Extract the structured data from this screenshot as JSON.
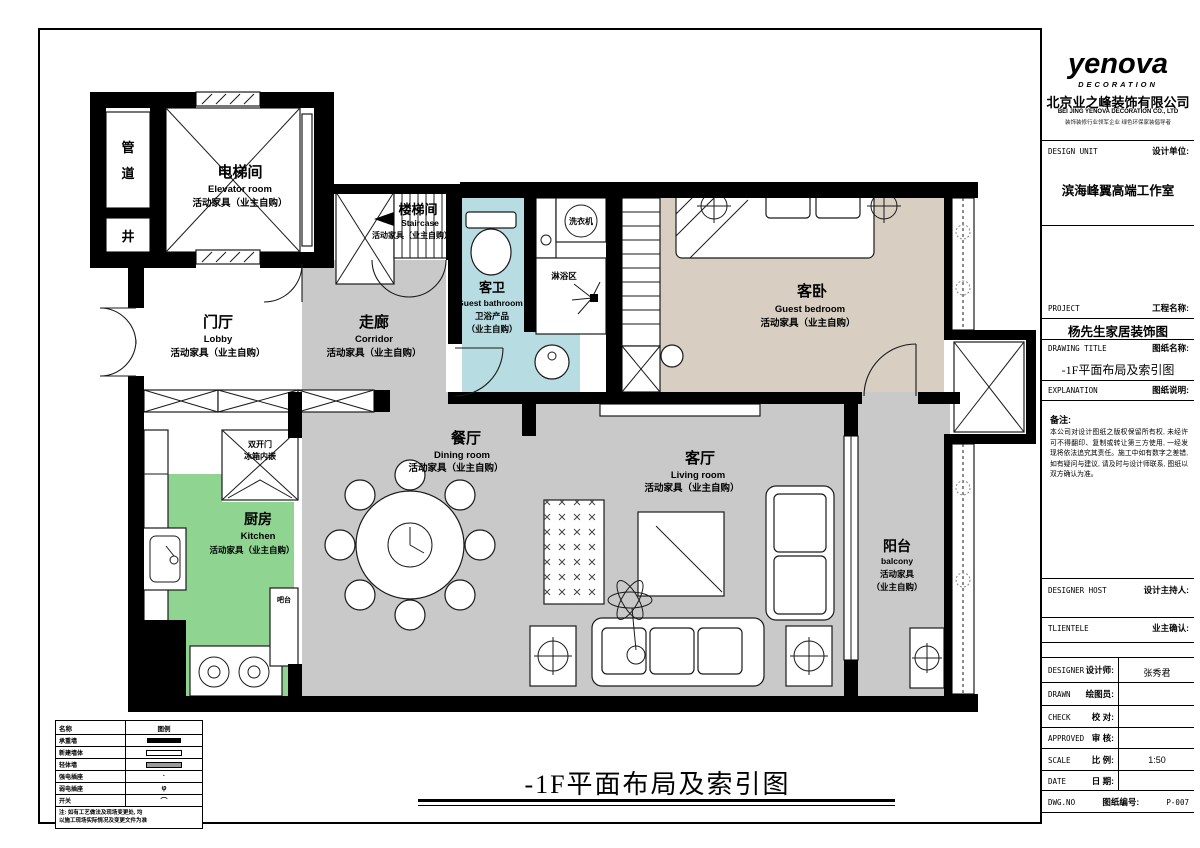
{
  "sheet": {
    "footer_title": "-1F平面布局及索引图"
  },
  "title_block": {
    "logo_text": "yenova",
    "logo_sub": "DECORATION",
    "company_cn": "北京业之峰装饰有限公司",
    "company_en": "BEI JING YENOVA DECORATION CO., LTD",
    "company_tagline": "装饰装修行业领军企业 绿色环保家装倡导者",
    "design_unit_en": "DESIGN UNIT",
    "design_unit_cn": "设计单位:",
    "design_unit_value": "滨海峰翼高端工作室",
    "project_en": "PROJECT",
    "project_cn": "工程名称:",
    "project_value": "杨先生家居装饰图",
    "drawing_title_en": "DRAWING TITLE",
    "drawing_title_cn": "图纸名称:",
    "drawing_title_value": "-1F平面布局及索引图",
    "explanation_en": "EXPLANATION",
    "explanation_cn": "图纸说明:",
    "note_label": "备注:",
    "note_text": "本公司对设计图纸之版权保留所有权, 未经许可不得翻印、复制或转让第三方使用, 一经发现将依法追究其责任。施工中如有数字之差错, 如有疑问与建议, 请及时与设计师联系, 图纸以双方确认为准。",
    "designer_host_en": "DESIGNER HOST",
    "designer_host_cn": "设计主持人:",
    "clientele_en": "TLIENTELE",
    "clientele_cn": "业主确认:",
    "designer_en": "DESIGNER",
    "designer_cn": "设计师:",
    "designer_value": "张秀君",
    "drawn_en": "DRAWN",
    "drawn_cn": "绘图员:",
    "check_en": "CHECK",
    "check_cn": "校 对:",
    "approved_en": "APPROVED",
    "approved_cn": "审 核:",
    "scale_en": "SCALE",
    "scale_cn": "比 例:",
    "scale_value": "1:50",
    "date_en": "DATE",
    "date_cn": "日 期:",
    "dwg_en": "DWG.NO",
    "dwg_cn": "图纸编号:",
    "dwg_value": "P-007"
  },
  "plan": {
    "shaft": {
      "c1": "管",
      "c2": "道",
      "c3": "井"
    },
    "elevator": {
      "cn": "电梯间",
      "en": "Elevator room",
      "note": "活动家具（业主自购）"
    },
    "staircase": {
      "cn": "楼梯间",
      "en": "Staircase",
      "note": "活动家具（业主自购）"
    },
    "lobby": {
      "cn": "门厅",
      "en": "Lobby",
      "note": "活动家具（业主自购）"
    },
    "corridor": {
      "cn": "走廊",
      "en": "Corridor",
      "note": "活动家具（业主自购）"
    },
    "guest_bathroom": {
      "cn": "客卫",
      "en": "Guest bathroom",
      "note1": "卫浴产品",
      "note2": "（业主自购）"
    },
    "washer": "洗衣机",
    "shower": "淋浴区",
    "guest_bedroom": {
      "cn": "客卧",
      "en": "Guest bedroom",
      "note": "活动家具（业主自购）"
    },
    "dining": {
      "cn": "餐厅",
      "en": "Dining room",
      "note": "活动家具（业主自购）"
    },
    "living": {
      "cn": "客厅",
      "en": "Living room",
      "note": "活动家具（业主自购）"
    },
    "kitchen": {
      "cn": "厨房",
      "en": "Kitchen",
      "note": "活动家具（业主自购）"
    },
    "balcony": {
      "cn": "阳台",
      "en": "balcony",
      "note1": "活动家具",
      "note2": "（业主自购）"
    },
    "fridge": {
      "line1": "双开门",
      "line2": "冰箱内嵌"
    },
    "bar": "吧台"
  },
  "legend": {
    "header_name": "名称",
    "header_symbol": "图例",
    "rows": [
      {
        "label": "承重墙"
      },
      {
        "label": "新建墙体"
      },
      {
        "label": "轻体墙"
      },
      {
        "label": "强电插座",
        "glyph": "·"
      },
      {
        "label": "弱电插座",
        "glyph": "φ"
      },
      {
        "label": "开关",
        "glyph": "⌒"
      }
    ],
    "note_line1": "注: 如有工艺做法及现场变更处, 均",
    "note_line2": "以施工现场实际情况及变更文件为准"
  },
  "colors": {
    "wall": "#000000",
    "room_gray": "#c9c9c9",
    "kitchen_green": "#90d492",
    "bathroom_blue": "#b7dce2",
    "bedroom_tan": "#d8cec2"
  }
}
